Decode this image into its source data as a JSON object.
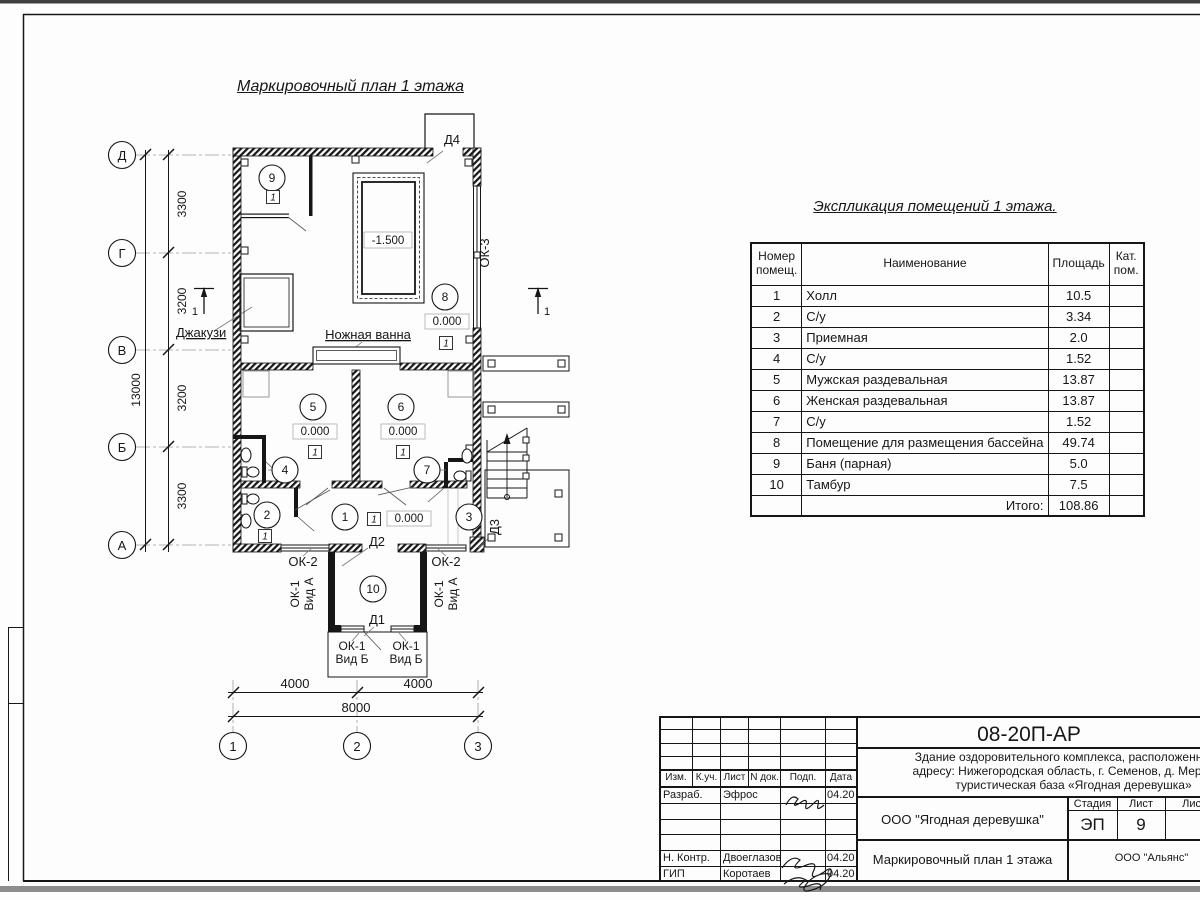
{
  "titles": {
    "plan": "Маркировочный план 1 этажа",
    "explication": "Экспликация помещений 1 этажа."
  },
  "axes": {
    "rows": [
      "Д",
      "Г",
      "В",
      "Б",
      "А"
    ],
    "cols": [
      "1",
      "2",
      "3"
    ]
  },
  "dims": {
    "row_segments": [
      "3300",
      "3200",
      "3200",
      "3300"
    ],
    "row_total": "13000",
    "col_segments": [
      "4000",
      "4000"
    ],
    "col_total": "8000"
  },
  "plan": {
    "bubbles": [
      "1",
      "2",
      "3",
      "4",
      "5",
      "6",
      "7",
      "8",
      "9",
      "10"
    ],
    "levels": {
      "zero": "0.000",
      "pool": "-1.500"
    },
    "floor_marker": "1",
    "section_mark": "1",
    "labels": {
      "d1": "Д1",
      "d2": "Д2",
      "d3": "Д3",
      "d4": "Д4",
      "ok1": "ОК-1",
      "ok2": "ОК-2",
      "ok3": "ОК-3",
      "vid_a": "Вид А",
      "vid_b": "Вид Б",
      "jacuzzi": "Джакузи",
      "foot_bath": "Ножная ванна"
    }
  },
  "explication": {
    "headers": {
      "num": "Номер помещ.",
      "name": "Наименование",
      "area": "Площадь",
      "cat": "Кат. пом."
    },
    "rows": [
      [
        "1",
        "Холл",
        "10.5"
      ],
      [
        "2",
        "С/у",
        "3.34"
      ],
      [
        "3",
        "Приемная",
        "2.0"
      ],
      [
        "4",
        "С/у",
        "1.52"
      ],
      [
        "5",
        "Мужская раздевальная",
        "13.87"
      ],
      [
        "6",
        "Женская раздевальная",
        "13.87"
      ],
      [
        "7",
        "С/у",
        "1.52"
      ],
      [
        "8",
        "Помещение для размещения бассейна",
        "49.74"
      ],
      [
        "9",
        "Баня (парная)",
        "5.0"
      ],
      [
        "10",
        "Тамбур",
        "7.5"
      ]
    ],
    "total_label": "Итого:",
    "total_value": "108.86"
  },
  "titleblock": {
    "doc_number": "08-20П-АР",
    "subject_line1": "Здание оздоровительного комплекса, расположенное по",
    "subject_line2": "адресу: Нижегородская область, г. Семенов, д. Мериново",
    "subject_line3": "туристическая база «Ягодная деревушка»",
    "rev_headers": [
      "Изм.",
      "К.уч.",
      "Лист",
      "N док.",
      "Подп.",
      "Дата"
    ],
    "staff": [
      {
        "role": "Разраб.",
        "name": "Эфрос",
        "date": "04.20"
      },
      {
        "role": "Н. Контр.",
        "name": "Двоеглазов",
        "date": "04.20"
      },
      {
        "role": "ГИП",
        "name": "Коротаев",
        "date": "04.20"
      }
    ],
    "company": "ООО \"Ягодная деревушка\"",
    "stage_label": "Стадия",
    "sheet_label": "Лист",
    "sheets_label": "Листов",
    "stage": "ЭП",
    "sheet_number": "9",
    "sheet_title": "Маркировочный план 1 этажа",
    "contractor": "ООО \"Альянс\""
  }
}
